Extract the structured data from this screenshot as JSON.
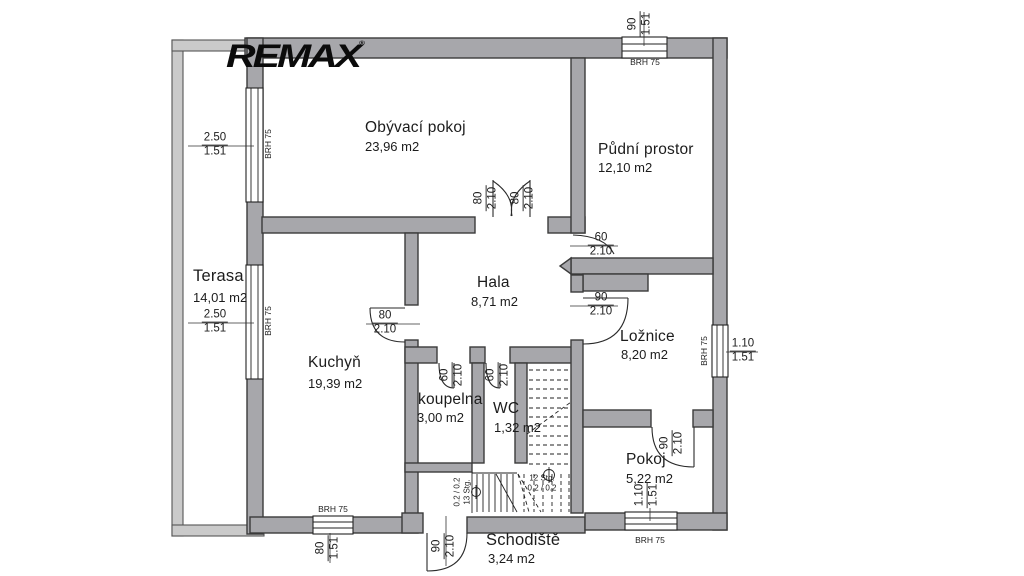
{
  "brand": {
    "logo_text": "REMAX",
    "registered_mark": "®"
  },
  "colors": {
    "wall_fill": "#a7a7ab",
    "wall_outline": "#3b3b3b",
    "terrace_fill": "#cacaca",
    "text": "#1c1c1c",
    "logo": "#0b0b0b",
    "background": "#ffffff",
    "line": "#2a2a2a"
  },
  "rooms": [
    {
      "name": "Obývací pokoj",
      "area": "23,96 m2"
    },
    {
      "name": "Půdní prostor",
      "area": "12,10 m2"
    },
    {
      "name": "Terasa",
      "area": "14,01 m2"
    },
    {
      "name": "Hala",
      "area": "8,71 m2"
    },
    {
      "name": "Kuchyň",
      "area": "19,39 m2"
    },
    {
      "name": "Ložnice",
      "area": "8,20 m2"
    },
    {
      "name": "koupelna",
      "area": "3,00 m2"
    },
    {
      "name": "WC",
      "area": "1,32 m2"
    },
    {
      "name": "Pokoj",
      "area": "5,22 m2"
    },
    {
      "name": "Schodiště",
      "area": "3,24 m2"
    }
  ],
  "windows": [
    {
      "width": "2.50",
      "sill": "1.51",
      "brh": "BRH 75"
    },
    {
      "width": "2.50",
      "sill": "1.51",
      "brh": "BRH 75"
    },
    {
      "width": "90",
      "sill": "1.51",
      "brh": "BRH 75"
    },
    {
      "width": "1.10",
      "sill": "1.51",
      "brh": "BRH 75"
    },
    {
      "width": "80",
      "sill": "1.51",
      "brh": "BRH 75"
    },
    {
      "width": "1.10",
      "sill": "1.51",
      "brh": "BRH 75"
    }
  ],
  "doors": [
    {
      "width": "80",
      "height": "2.10"
    },
    {
      "width": "80",
      "height": "2.10"
    },
    {
      "width": "60",
      "height": "2.10"
    },
    {
      "width": "90",
      "height": "2.10"
    },
    {
      "width": "80",
      "height": "2.10"
    },
    {
      "width": "60",
      "height": "2.10"
    },
    {
      "width": "60",
      "height": "2.10"
    },
    {
      "width": "90",
      "height": "2.10"
    },
    {
      "width": "90",
      "height": "2.10"
    }
  ],
  "stairs": {
    "down_note": "0.2 / 0.2",
    "down_steps": "13 Stg.",
    "up_steps": "12 Stg.",
    "up_note": "0.2 / 0.2"
  }
}
